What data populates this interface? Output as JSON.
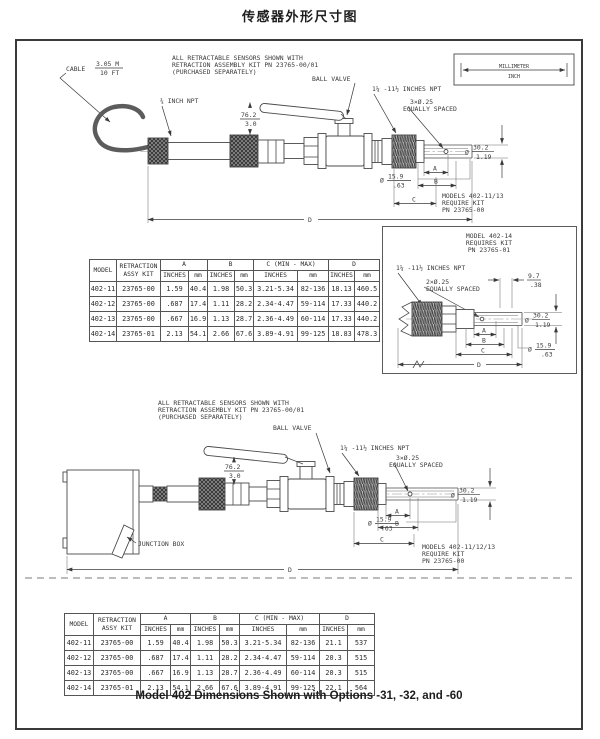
{
  "page": {
    "title": "传感器外形尺寸图",
    "caption": "Model 402 Dimensions Shown with Options -31, -32, and -60"
  },
  "legend": {
    "millimeter": "MILLIMETER",
    "inch": "INCH"
  },
  "diagram1": {
    "note1": "ALL RETRACTABLE SENSORS SHOWN WITH",
    "note2": "RETRACTION ASSEMBLY KIT PN 23765-00/01",
    "note3": "(PURCHASED SEPARATELY)",
    "cable_label": "CABLE",
    "cable_m": "3.05 M",
    "cable_ft": "10 FT",
    "npt_small": "¾ INCH NPT",
    "ball_valve": "BALL VALVE",
    "clearance_mm": "76.2",
    "clearance_in": "3.0",
    "npt_large": "1¼ -11½ INCHES NPT",
    "holes": "3×Ø.25",
    "equally_spaced": "EQUALLY SPACED",
    "dia_symbol": "Ø",
    "dia_outer_mm": "30.2",
    "dia_outer_in": "1.19",
    "dia_tip_mm": "15.9",
    "dia_tip_in": ".63",
    "dim_a": "A",
    "dim_b": "B",
    "dim_c": "C",
    "dim_d": "D",
    "models_note1": "MODELS 402-11/13",
    "models_note2": "REQUIRE KIT",
    "models_note3": "PN 23765-00"
  },
  "inset": {
    "title1": "MODEL 402-14",
    "title2": "REQUIRES KIT",
    "title3": "PN 23765-01",
    "npt_large": "1¼ -11½ INCHES NPT",
    "holes": "2×Ø.25",
    "equally_spaced": "EQUALLY SPACED",
    "tip_mm": "9.7",
    "tip_in": ".38",
    "dia_symbol": "Ø",
    "dia_outer_mm": "30.2",
    "dia_outer_in": "1.19",
    "dia_tip_mm": "15.9",
    "dia_tip_in": ".63",
    "dim_a": "A",
    "dim_b": "B",
    "dim_c": "C",
    "dim_d": "D"
  },
  "diagram2": {
    "note1": "ALL RETRACTABLE SENSORS SHOWN WITH",
    "note2": "RETRACTION ASSEMBLY KIT PN 23765-00/01",
    "note3": "(PURCHASED SEPARATELY)",
    "ball_valve": "BALL VALVE",
    "clearance_mm": "76.2",
    "clearance_in": "3.0",
    "junction_box": "JUNCTION BOX",
    "npt_large": "1¼ -11½ INCHES NPT",
    "holes": "3×Ø.25",
    "equally_spaced": "EQUALLY SPACED",
    "dia_symbol": "Ø",
    "dia_outer_mm": "30.2",
    "dia_outer_in": "1.19",
    "dia_tip_mm": "15.9",
    "dia_tip_in": ".63",
    "dim_a": "A",
    "dim_b": "B",
    "dim_c": "C",
    "dim_d": "D",
    "models_note1": "MODELS 402-11/12/13",
    "models_note2": "REQUIRE KIT",
    "models_note3": "PN 23765-00"
  },
  "table1": {
    "headers": {
      "model": "MODEL",
      "kit1": "RETRACTION",
      "kit2": "ASSY KIT",
      "a": "A",
      "b": "B",
      "c": "C (MIN - MAX)",
      "d": "D",
      "inches": "INCHES",
      "mm": "mm"
    },
    "rows": [
      [
        "402-11",
        "23765-00",
        "1.59",
        "40.4",
        "1.98",
        "50.3",
        "3.21-5.34",
        "82-136",
        "18.13",
        "460.5"
      ],
      [
        "402-12",
        "23765-00",
        ".687",
        "17.4",
        "1.11",
        "28.2",
        "2.34-4.47",
        "59-114",
        "17.33",
        "440.2"
      ],
      [
        "402-13",
        "23765-00",
        ".667",
        "16.9",
        "1.13",
        "28.7",
        "2.36-4.49",
        "60-114",
        "17.33",
        "440.2"
      ],
      [
        "402-14",
        "23765-01",
        "2.13",
        "54.1",
        "2.66",
        "67.6",
        "3.89-4.91",
        "99-125",
        "18.83",
        "478.3"
      ]
    ]
  },
  "table2": {
    "headers": {
      "model": "MODEL",
      "kit1": "RETRACTION",
      "kit2": "ASSY KIT",
      "a": "A",
      "b": "B",
      "c": "C (MIN - MAX)",
      "d": "D",
      "inches": "INCHES",
      "mm": "mm"
    },
    "rows": [
      [
        "402-11",
        "23765-00",
        "1.59",
        "40.4",
        "1.98",
        "50.3",
        "3.21-5.34",
        "82-136",
        "21.1",
        "537"
      ],
      [
        "402-12",
        "23765-00",
        ".687",
        "17.4",
        "1.11",
        "28.2",
        "2.34-4.47",
        "59-114",
        "20.3",
        "515"
      ],
      [
        "402-13",
        "23765-00",
        ".667",
        "16.9",
        "1.13",
        "28.7",
        "2.36-4.49",
        "60-114",
        "20.3",
        "515"
      ],
      [
        "402-14",
        "23765-01",
        "2.13",
        "54.1",
        "2.66",
        "67.6",
        "3.89-4.91",
        "99-125",
        "22.1",
        "564"
      ]
    ]
  }
}
